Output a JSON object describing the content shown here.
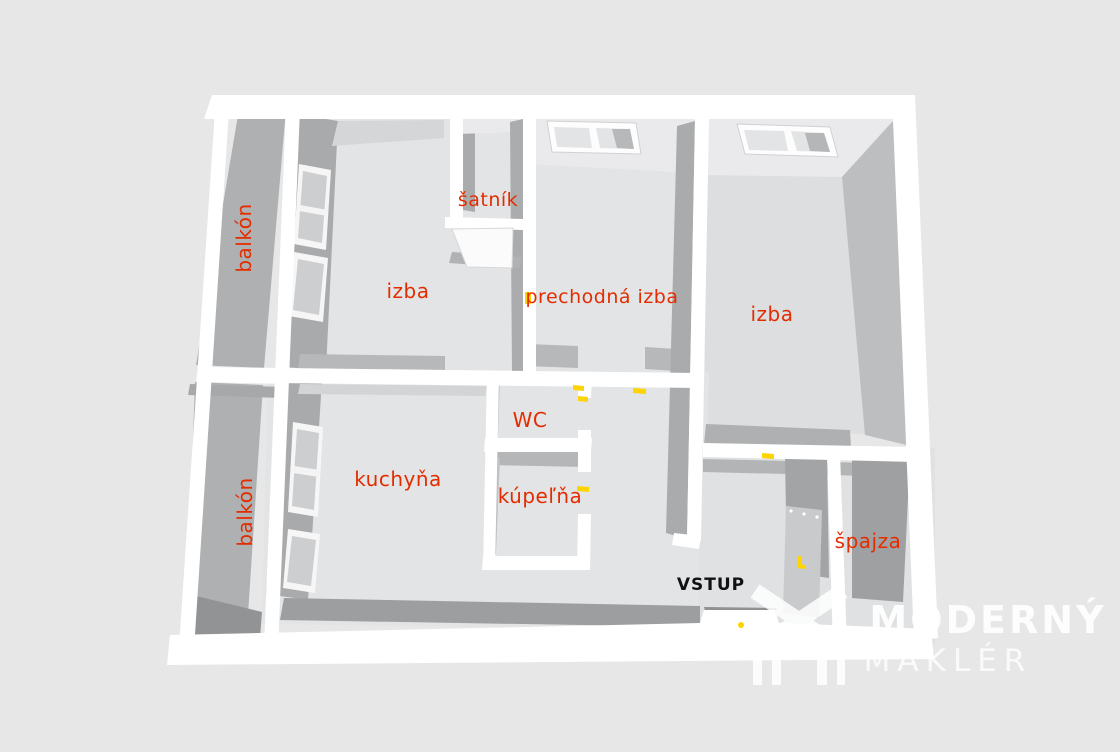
{
  "floorplan": {
    "rooms": {
      "balkon_top": {
        "label": "balkón"
      },
      "balkon_bottom": {
        "label": "balkón"
      },
      "izba_left": {
        "label": "izba"
      },
      "satnik": {
        "label": "šatník"
      },
      "prechodna": {
        "label": "prechodná izba"
      },
      "izba_right": {
        "label": "izba"
      },
      "kuchyna": {
        "label": "kuchyňa"
      },
      "wc": {
        "label": "WC"
      },
      "kupelna": {
        "label": "kúpeľňa"
      },
      "spajza": {
        "label": "špajza"
      }
    },
    "entrance": {
      "label": "VSTUP"
    }
  },
  "watermark": {
    "line1": "MODERNÝ",
    "line2": "MAKLÉR"
  },
  "colors": {
    "background": "#e7e7e7",
    "walls": "#ffffff",
    "floor": "#e2e4e6",
    "wall_face_dark": "#a8aaac",
    "room_label": "#e32d00",
    "entrance_label": "#111111",
    "door_marker": "#ffd400",
    "watermark": "#ffffff"
  }
}
